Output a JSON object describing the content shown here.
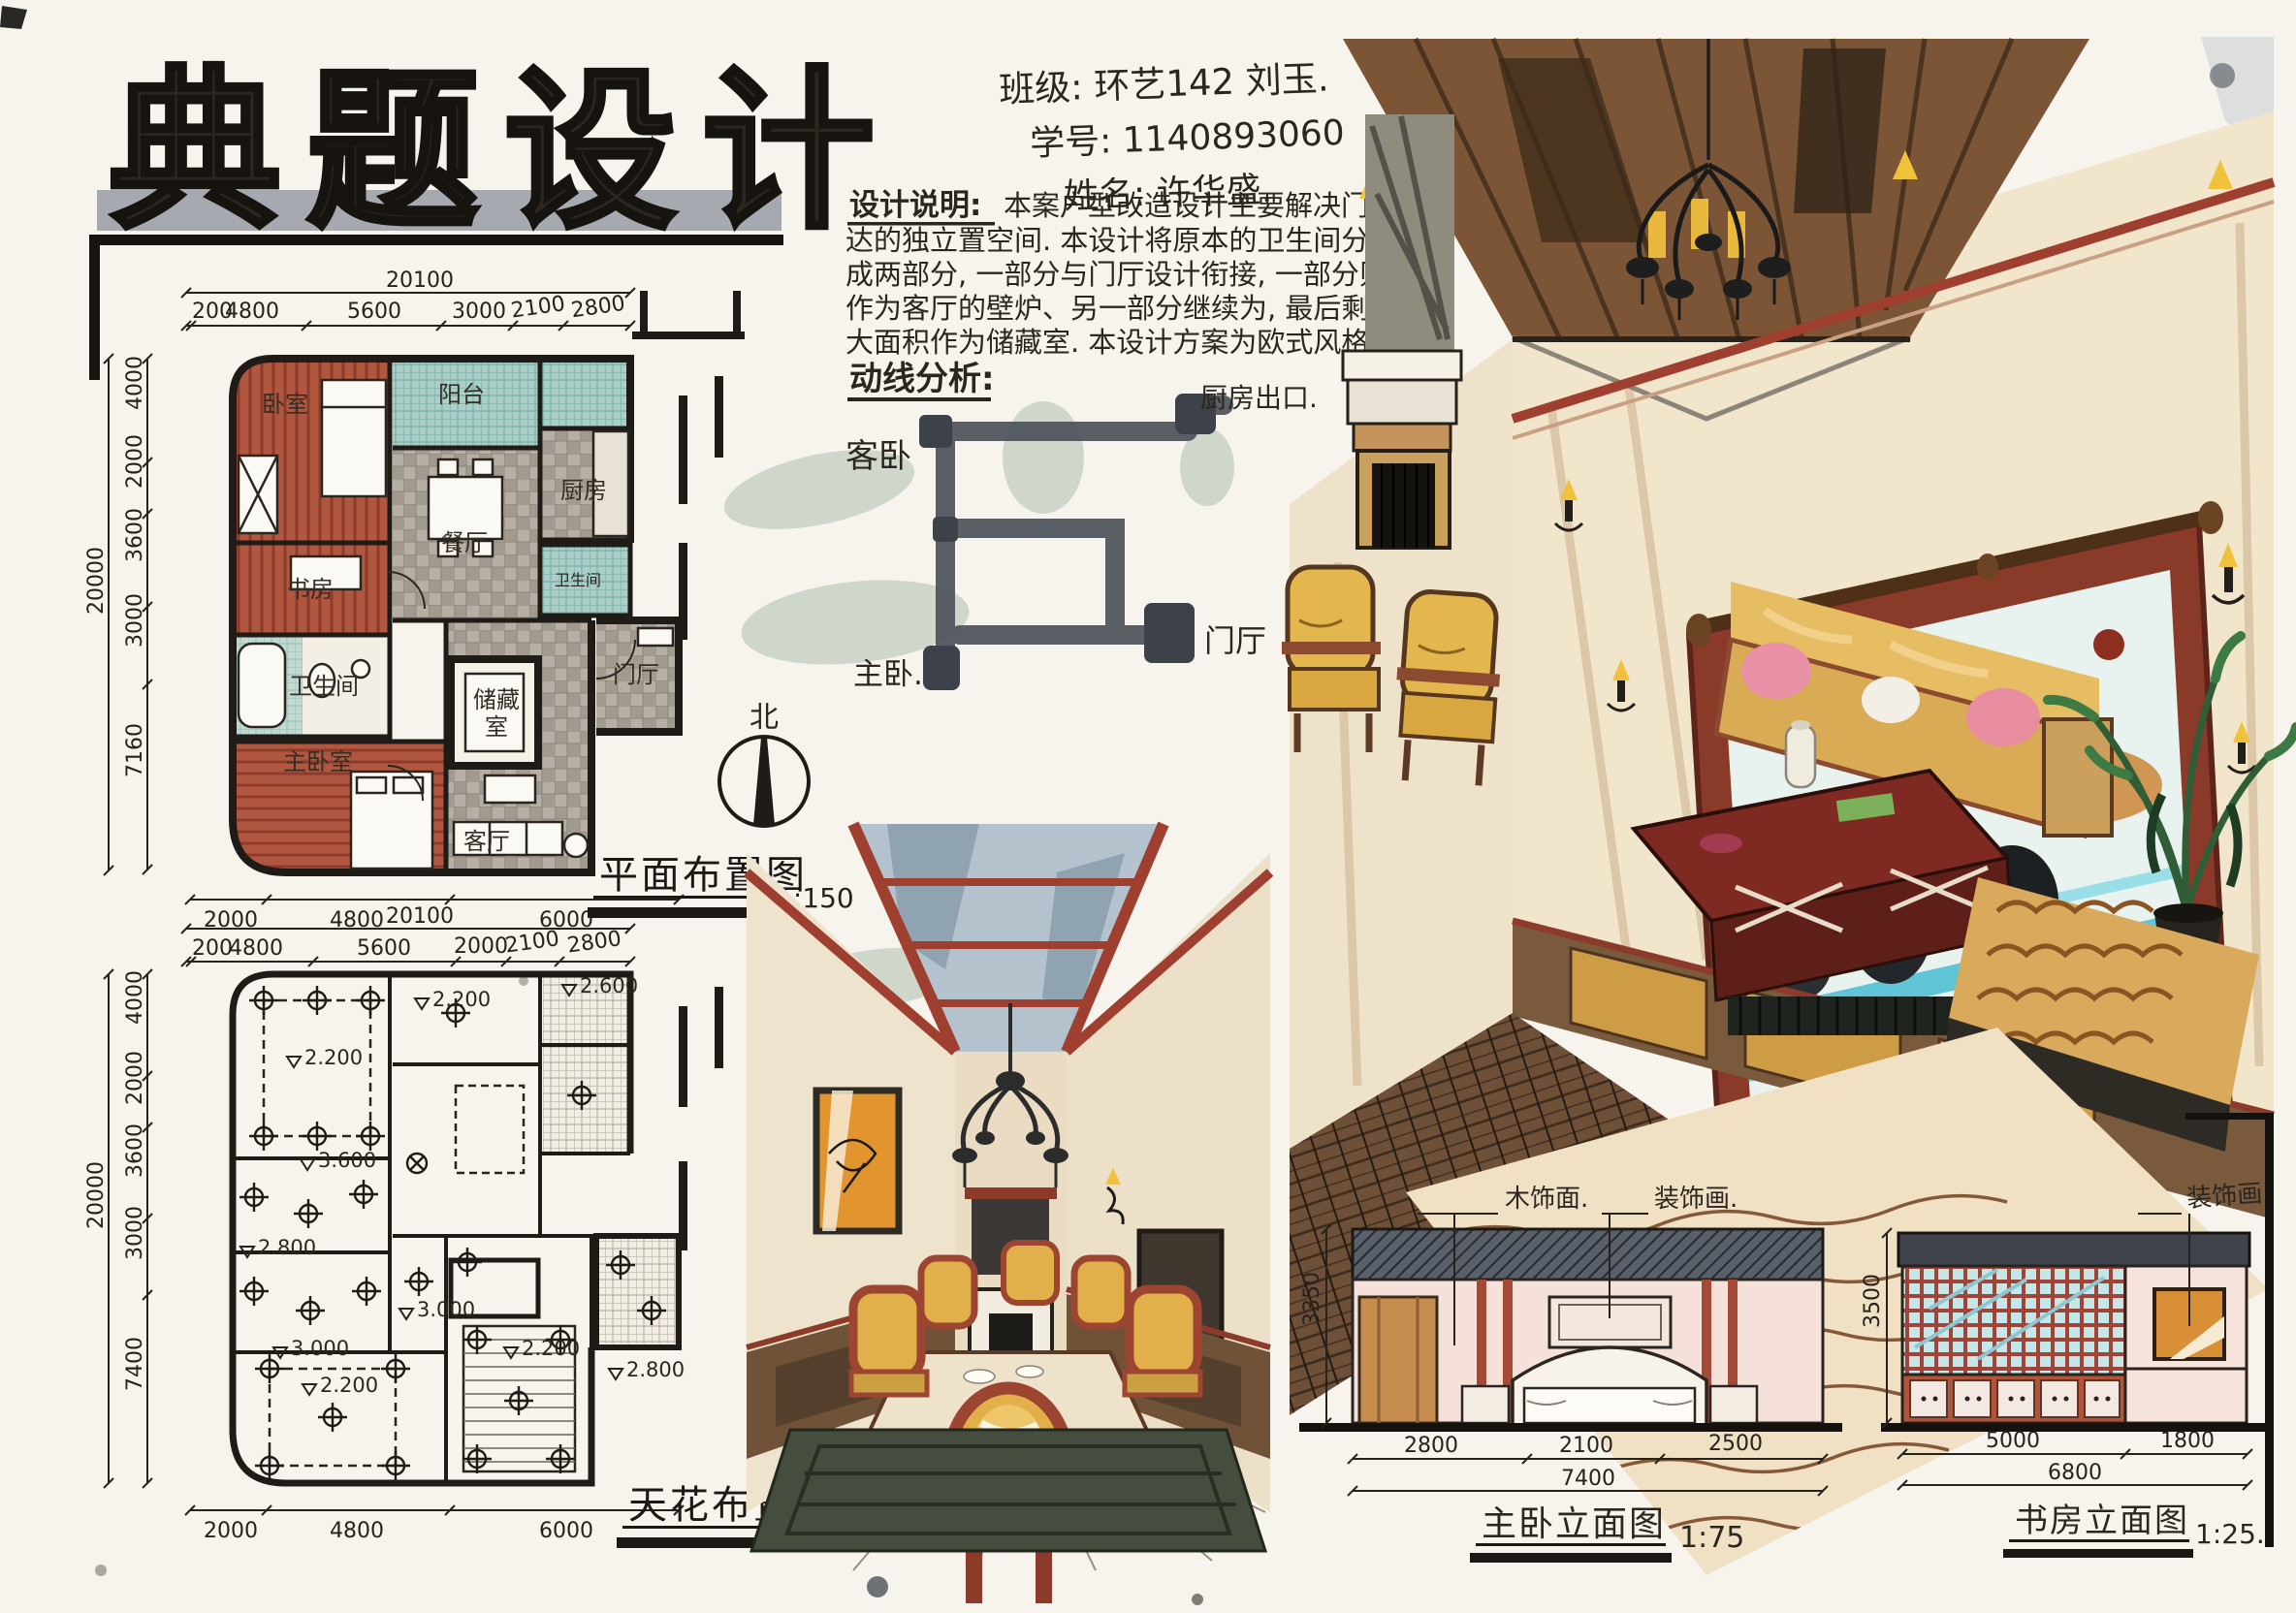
{
  "colors": {
    "paper": "#f7f4ed",
    "ink": "#1f1b16",
    "wood_red": "#b2573f",
    "tile_gray": "#aaa298",
    "bath_teal": "#a9cfc7",
    "beam_red": "#9e3f30",
    "chair_yellow": "#e2b04a",
    "rug_green": "#454e3e",
    "flow_gray": "#4d525b",
    "blob_green": "#c8d1c4",
    "mirror_teal": "#5ec4d6",
    "dark_wood": "#6e4f38",
    "elev_wall_pink": "#f5e1da",
    "art_orange": "#d98f35"
  },
  "logo": {
    "text": "典题设计"
  },
  "student_info": {
    "class_line": "班级: 环艺142 刘玉.",
    "id_line": "学号: 1140893060",
    "name_line": "姓名: 许华盛."
  },
  "design_notes": {
    "heading": "设计说明:",
    "line1": "本案户型改造设计主要解决门厅到",
    "line2": "达的独立置空间. 本设计将原本的卫生间分",
    "line3": "成两部分, 一部分与门厅设计衔接, 一部分则",
    "line4": "作为客厅的壁炉、另一部分继续为, 最后剩下的",
    "line5": "大面积作为储藏室. 本设计方案为欧式风格."
  },
  "circulation": {
    "heading": "动线分析:",
    "kitchen_exit": "厨房出口.",
    "guest_bedroom": "客卧",
    "entry": "门厅",
    "master_bedroom": "主卧."
  },
  "north_label": "北",
  "floor_plan": {
    "title": "平面布置图",
    "scale": "1:150",
    "dim_total_top": "20100",
    "dim_total_left": "20000",
    "dims_top": [
      "200",
      "4800",
      "5600",
      "3000",
      "2100",
      "2800"
    ],
    "dims_left": [
      "4000",
      "2000",
      "3600",
      "3000",
      "7160"
    ],
    "dims_bottom": [
      "2000",
      "4800",
      "6000"
    ],
    "rooms": {
      "bedroom": "卧室",
      "balcony": "阳台",
      "dining": "餐厅",
      "kitchen": "厨房",
      "study": "书房",
      "bath": "卫生间",
      "bath_small": "卫生间",
      "master_bedroom": "主卧室",
      "storage_line1": "储藏",
      "storage_line2": "室",
      "living": "客厅",
      "entry": "门厅"
    }
  },
  "ceiling_plan": {
    "title": "天花布置图",
    "scale": "1:150",
    "dim_total_top": "20100",
    "dim_total_left": "20000",
    "dims_top": [
      "200",
      "4800",
      "5600",
      "2000",
      "2100",
      "2800"
    ],
    "dims_left": [
      "4000",
      "2000",
      "3600",
      "3000",
      "7400"
    ],
    "dims_bottom": [
      "2000",
      "4800",
      "6000"
    ],
    "heights": [
      "2.200",
      "2.200",
      "2.600",
      "3.600",
      "2.800",
      "3.000",
      "3.000",
      "2.800",
      "2.200",
      "2.200"
    ]
  },
  "elevations": {
    "master": {
      "title": "主卧立面图",
      "scale": "1:75",
      "label_wood": "木饰面.",
      "label_art": "装饰画.",
      "dims_bottom": [
        "2800",
        "2100",
        "2500"
      ],
      "dim_total": "7400",
      "dim_height": "3350"
    },
    "study": {
      "title": "书房立面图",
      "scale": "1:25.",
      "label_art": "装饰画.",
      "dims_bottom": [
        "5000",
        "1800"
      ],
      "dim_total": "6800",
      "dim_height": "3500"
    }
  }
}
